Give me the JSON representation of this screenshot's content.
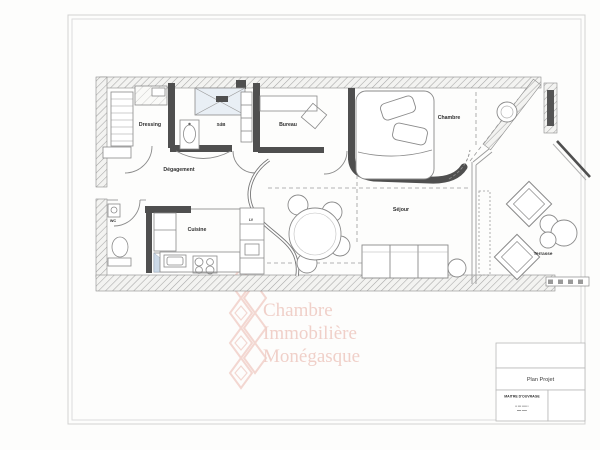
{
  "document_type": "apartment-floor-plan-scan",
  "rooms": {
    "dressing": "Dressing",
    "degagement": "Dégagement",
    "sdb": "SdB",
    "bureau": "Bureau",
    "chambre": "Chambre",
    "wc": "WC",
    "cuisine": "Cuisine",
    "lv": "LV",
    "sejour": "Séjour",
    "terrasse": "Terrasse"
  },
  "watermark": {
    "line1": "Chambre",
    "line2": "Immobilière",
    "line3": "Monégasque",
    "color": "#f0d0c9"
  },
  "title_block": {
    "plan_title": "Plan Projet",
    "owner_label": "MAITRE D'OUVRAGE",
    "owner_line1": "▪▪ ▪▪▪ ▪▪▪▪▪ ▪",
    "owner_line2": "▪▪▪▪ ▪▪▪▪▪"
  },
  "icons": {
    "diamond_logo": "lozenge-lattice",
    "scale_bar": "segmented-ruler"
  },
  "colors": {
    "wall_dark": "#4f4f4f",
    "line_gray": "#8a8a8a",
    "glass_blue": "#ccd9e7",
    "watermark_pink": "#f0d0c9"
  }
}
